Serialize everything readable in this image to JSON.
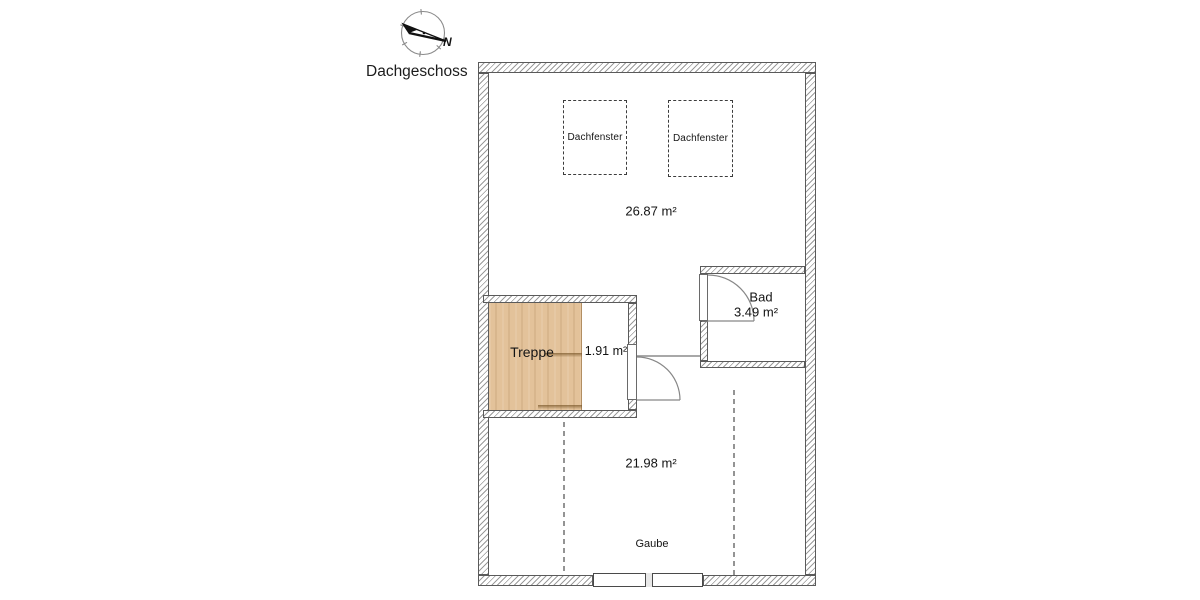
{
  "header": {
    "title": "Dachgeschoss"
  },
  "compass": {
    "north_label": "N"
  },
  "floor_plan": {
    "attic_room": {
      "area": "26.87 m²"
    },
    "skylights": [
      {
        "label": "Dachfenster"
      },
      {
        "label": "Dachfenster"
      }
    ],
    "stairs": {
      "name": "Treppe",
      "landing_area": "1.91 m²"
    },
    "bathroom": {
      "name": "Bad",
      "area": "3.49 m²"
    },
    "lower_room": {
      "area": "21.98 m²"
    },
    "dormer": {
      "label": "Gaube"
    }
  },
  "colors": {
    "wood": "#e3c29a",
    "hatch": "#9b9b9b",
    "wall-border": "#5a5a5a",
    "thin-line": "#878787",
    "text": "#141414"
  }
}
